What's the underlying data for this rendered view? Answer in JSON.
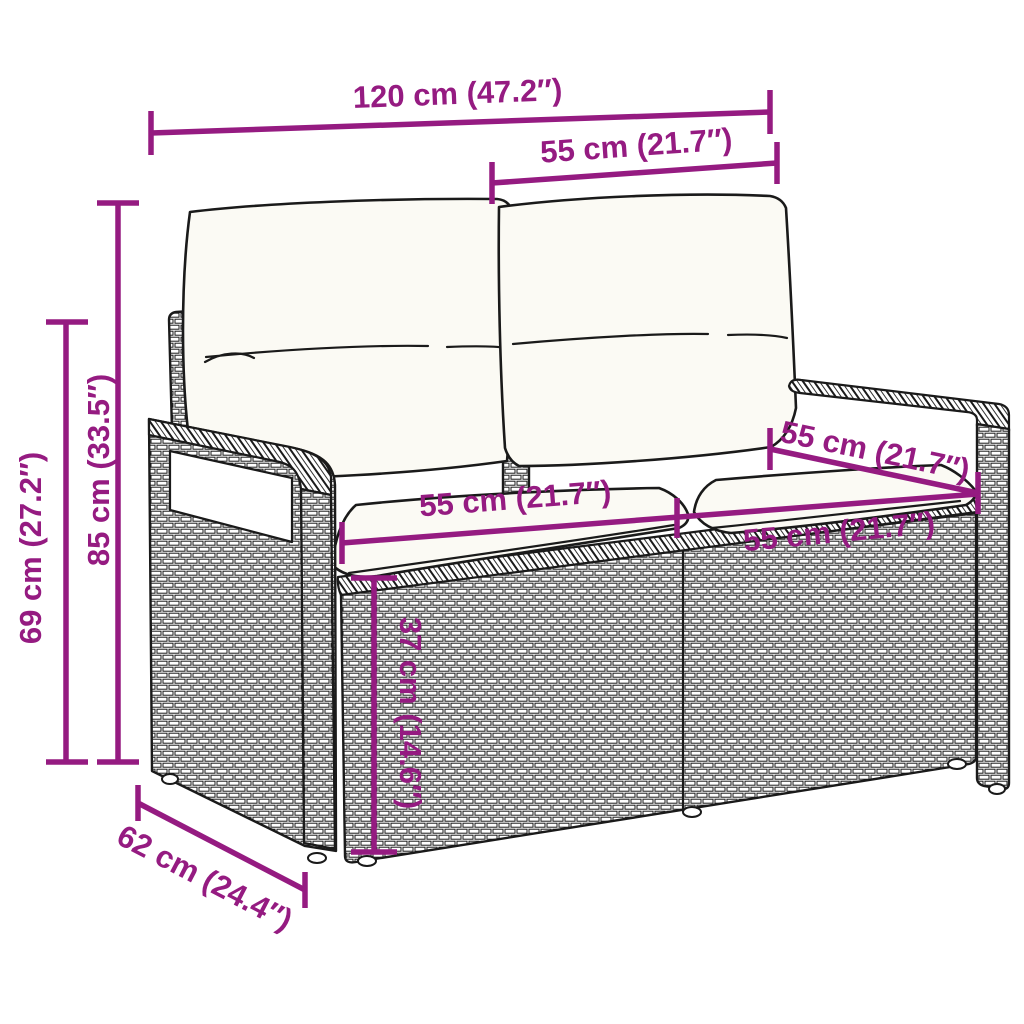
{
  "colors": {
    "dimension_color": "#951b81",
    "line_color": "#1a1a1a",
    "cushion_color": "#fbfaf4",
    "background_color": "#ffffff"
  },
  "diagram": {
    "subject": "2-seater poly rattan garden sofa with back and seat cushions, line-art dimension drawing",
    "dimensions": {
      "overall_width": "120 cm (47.2″)",
      "backrest_section_width": "55 cm (21.7″)",
      "total_height": "85 cm (33.5″)",
      "armrest_height": "69 cm (27.2″)",
      "seat_section_width_left": "55 cm (21.7″)",
      "seat_section_width_right": "55 cm (21.7″)",
      "seat_depth": "55 cm (21.7″)",
      "seat_height": "37 cm (14.6″)",
      "overall_depth": "62 cm (24.4″)"
    }
  }
}
